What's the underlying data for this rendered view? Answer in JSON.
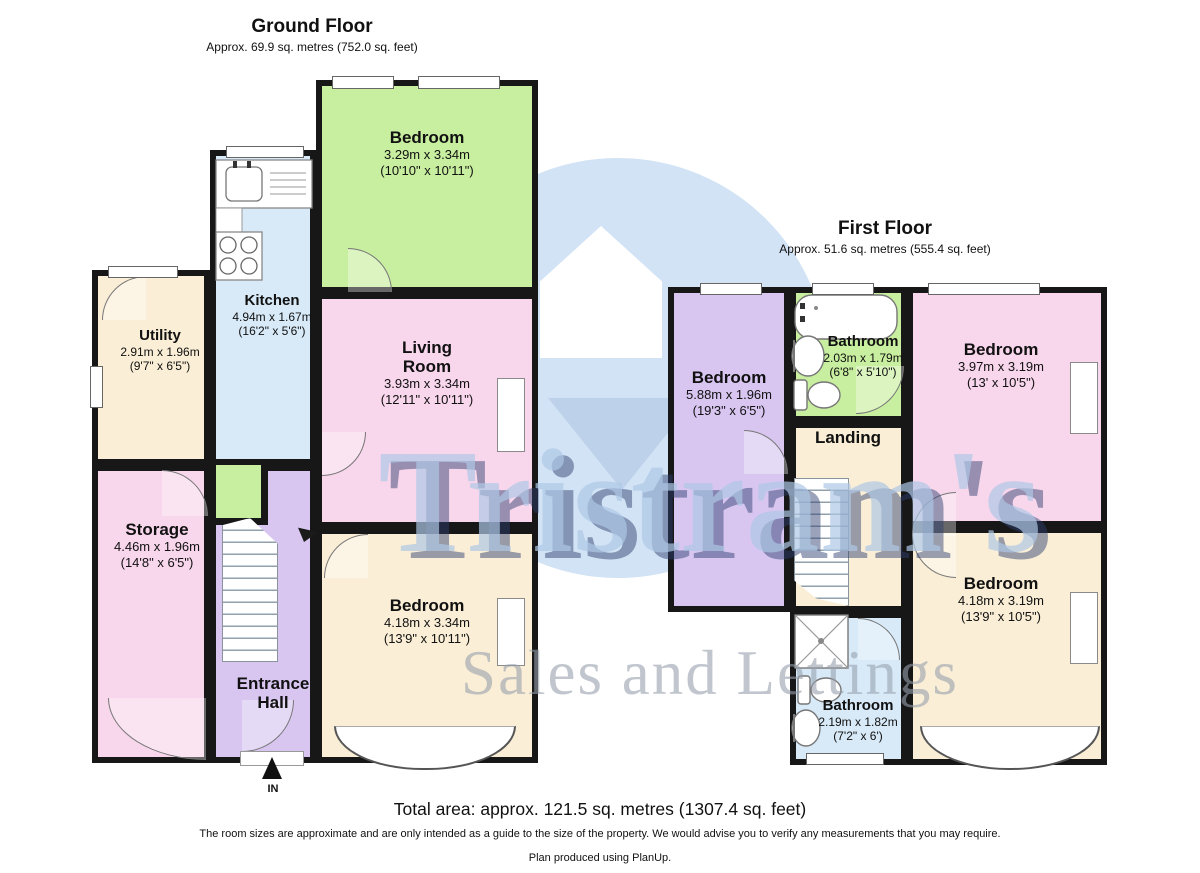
{
  "ground_floor": {
    "title": "Ground Floor",
    "subtitle": "Approx. 69.9 sq. metres (752.0 sq. feet)",
    "entrance_label": "IN",
    "rooms": {
      "bedroom_top": {
        "name": "Bedroom",
        "metric": "3.29m x 3.34m",
        "imperial": "(10'10\" x 10'11\")"
      },
      "kitchen": {
        "name": "Kitchen",
        "metric": "4.94m x 1.67m",
        "imperial": "(16'2\" x 5'6\")"
      },
      "living_room": {
        "name": "Living Room",
        "metric": "3.93m x 3.34m",
        "imperial": "(12'11\" x 10'11\")"
      },
      "utility": {
        "name": "Utility",
        "metric": "2.91m x 1.96m",
        "imperial": "(9'7\" x 6'5\")"
      },
      "storage": {
        "name": "Storage",
        "metric": "4.46m x 1.96m",
        "imperial": "(14'8\" x 6'5\")"
      },
      "bedroom_bottom": {
        "name": "Bedroom",
        "metric": "4.18m x 3.34m",
        "imperial": "(13'9\" x 10'11\")"
      },
      "entrance_hall": {
        "name": "Entrance Hall"
      }
    }
  },
  "first_floor": {
    "title": "First Floor",
    "subtitle": "Approx. 51.6 sq. metres (555.4 sq. feet)",
    "rooms": {
      "bedroom_left": {
        "name": "Bedroom",
        "metric": "5.88m x 1.96m",
        "imperial": "(19'3\" x 6'5\")"
      },
      "bathroom_top": {
        "name": "Bathroom",
        "metric": "2.03m x 1.79m",
        "imperial": "(6'8\" x 5'10\")"
      },
      "bedroom_top_right": {
        "name": "Bedroom",
        "metric": "3.97m x 3.19m",
        "imperial": "(13' x 10'5\")"
      },
      "landing": {
        "name": "Landing"
      },
      "bedroom_bottom_right": {
        "name": "Bedroom",
        "metric": "4.18m x 3.19m",
        "imperial": "(13'9\" x 10'5\")"
      },
      "bathroom_bottom": {
        "name": "Bathroom",
        "metric": "2.19m x 1.82m",
        "imperial": "(7'2\" x 6')"
      }
    }
  },
  "watermark": {
    "brand": "Tristram's",
    "tagline": "Sales and Lettings"
  },
  "footer": {
    "total": "Total area: approx. 121.5 sq. metres (1307.4 sq. feet)",
    "disclaimer": "The room sizes are approximate and are only intended as a guide to the size of the property. We would advise you to verify any measurements that you may require.",
    "credit": "Plan produced using PlanUp."
  },
  "colors": {
    "wall": "#171717",
    "room_green": "#c8ee9f",
    "room_pink": "#f8d6ec",
    "room_blue": "#d8eaf8",
    "room_cream": "#faeed6",
    "room_lavender": "#d8c6f1",
    "watermark_blue": "#d2e3f5",
    "watermark_navy": "#2d3f6e"
  }
}
